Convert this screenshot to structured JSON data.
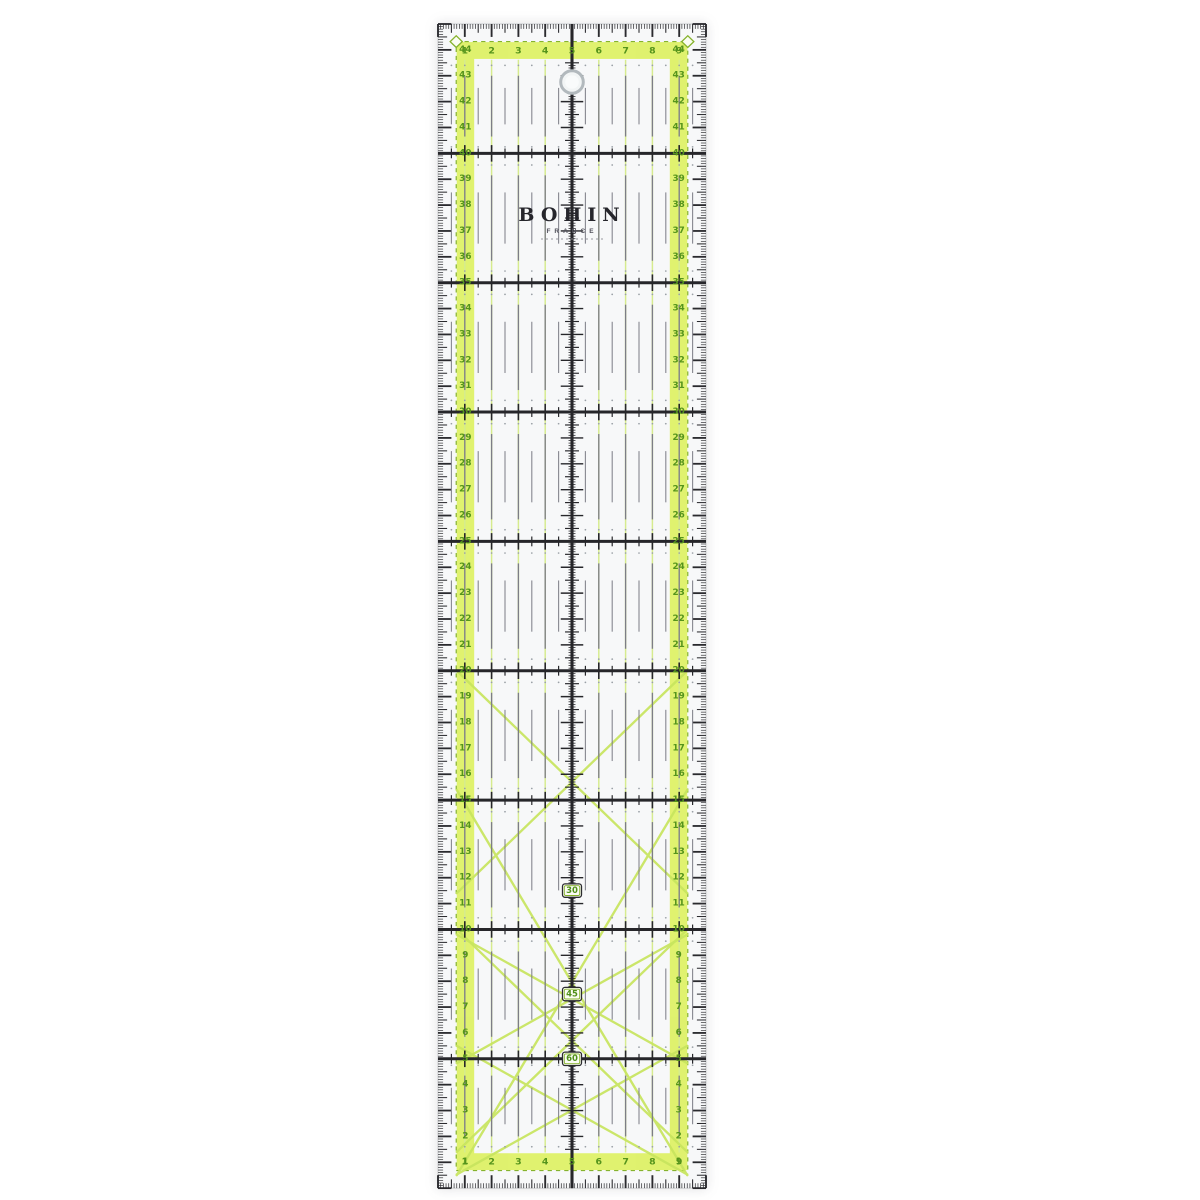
{
  "image_type": "product-photo of a transparent quilting ruler",
  "brand": {
    "name": "BOHIN",
    "country": "FRANCE"
  },
  "ruler": {
    "width_cm": 10,
    "length_cm": 45,
    "top_scale_numbers": [
      "1",
      "2",
      "3",
      "4",
      "5",
      "6",
      "7",
      "8",
      "9"
    ],
    "bottom_scale_numbers": [
      "1",
      "2",
      "3",
      "4",
      "5",
      "6",
      "7",
      "8",
      "9"
    ],
    "left_scale_numbers": [
      "44",
      "43",
      "42",
      "41",
      "40",
      "39",
      "38",
      "37",
      "36",
      "35",
      "34",
      "33",
      "32",
      "31",
      "30",
      "29",
      "28",
      "27",
      "26",
      "25",
      "24",
      "23",
      "22",
      "21",
      "20",
      "19",
      "18",
      "17",
      "16",
      "15",
      "14",
      "13",
      "12",
      "11",
      "10",
      "9",
      "8",
      "7",
      "6",
      "5",
      "4",
      "3",
      "2",
      "1"
    ],
    "right_scale_numbers": [
      "44",
      "43",
      "42",
      "41",
      "40",
      "39",
      "38",
      "37",
      "36",
      "35",
      "34",
      "33",
      "32",
      "31",
      "30",
      "29",
      "28",
      "27",
      "26",
      "25",
      "24",
      "23",
      "22",
      "21",
      "20",
      "19",
      "18",
      "17",
      "16",
      "15",
      "14",
      "13",
      "12",
      "11",
      "10",
      "9",
      "8",
      "7",
      "6",
      "5",
      "4",
      "3",
      "2",
      "1"
    ],
    "angle_labels": [
      "30",
      "45",
      "60"
    ],
    "colors": {
      "band": "#ddf163",
      "border_green": "#86b32d",
      "number_green": "#55941c",
      "grid_green": "#d6eb8e",
      "diagonal": "#c8e55e",
      "black": "#26262a",
      "dash_gray": "#7d7d86",
      "base_fill": "#f7f8f9",
      "edge": "#c9ccce",
      "hole_ring": "#b2b9bd"
    }
  }
}
